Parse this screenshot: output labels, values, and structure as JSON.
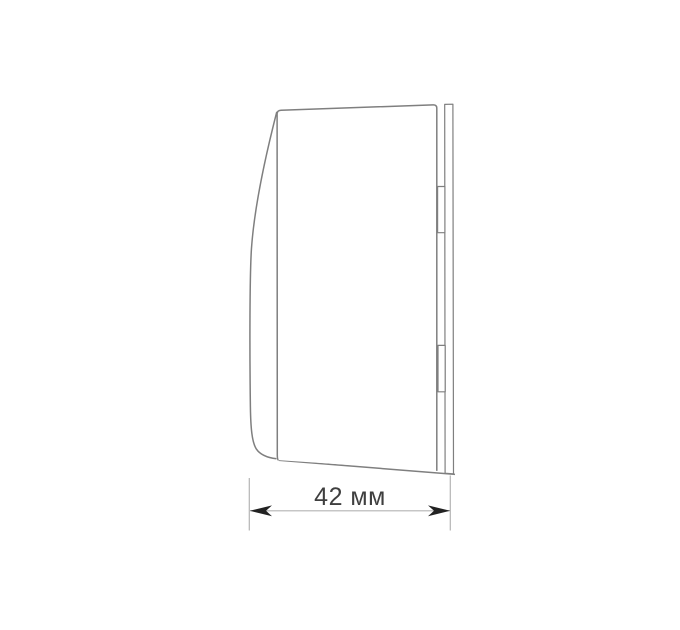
{
  "drawing": {
    "kind": "technical-side-view",
    "dimension": {
      "label": "42 мм",
      "value": "42",
      "unit": "мм"
    }
  },
  "colors": {
    "background": "#ffffff",
    "outline": "#7f7f7f",
    "dim-line": "#b4b4b4",
    "arrow": "#222222",
    "label-text": "#3f3f3f"
  }
}
